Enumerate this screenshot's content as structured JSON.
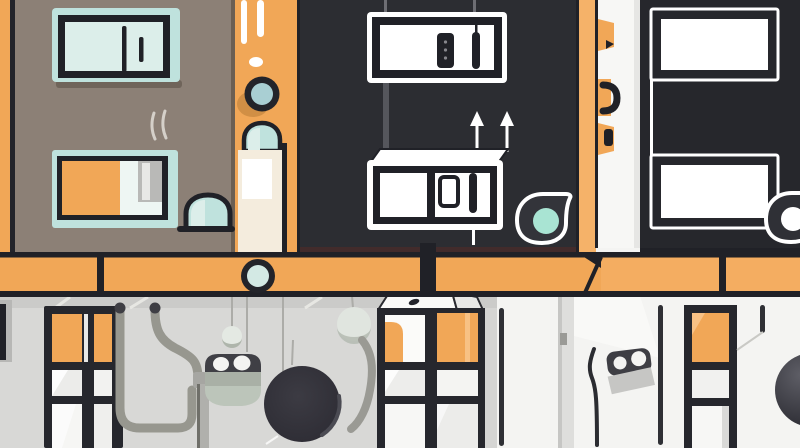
{
  "canvas": {
    "width": 800,
    "height": 448
  },
  "scene": {
    "style": "flat vector illustration",
    "subject": "stylized building cross-section with appliances, pipes and meters",
    "regions": [
      "taupe-wall-with-ac-and-stove",
      "orange-pillar-with-porthole",
      "charcoal-room-with-heaters",
      "service-strip-with-brackets",
      "dark-room-with-windows",
      "orange-floor-beam",
      "gray-basement-with-window-pipes-meter",
      "white-basement-with-radiators"
    ]
  },
  "palette": {
    "taupe": "#8C8076",
    "orange": "#F1A757",
    "orangeLight": "#F5B269",
    "orangeShadow": "#D18F45",
    "orangeHighlight": "#F8C184",
    "charcoal": "#2C2D32",
    "charcoalRight": "#26272C",
    "outline": "#202127",
    "maroon": "#422B2B",
    "tealLight": "#BFE2DD",
    "tealPale": "#DCEEEA",
    "tealMuted": "#A9CFD3",
    "mint": "#A9E4D3",
    "cream": "#F4ECDD",
    "white": "#FFFFFF",
    "offWhite": "#F4F4F2",
    "grayWall": "#D8D8D6",
    "grayCurb": "#CBCBC9",
    "grayPanel": "#DEDEDC",
    "pipeGray": "#97978F",
    "pipeDark": "#3E3E44",
    "sage": "#B7BFB2",
    "sageShadow": "#AEB5AB",
    "paleCircle": "#E0E5DF",
    "blobDark": "#34333B",
    "wireGray": "#ACACA8",
    "cableDark": "#2B2C31",
    "frameDark": "#26272D",
    "ringDark": "#23242A",
    "ringFill": "#D3E9E4"
  }
}
